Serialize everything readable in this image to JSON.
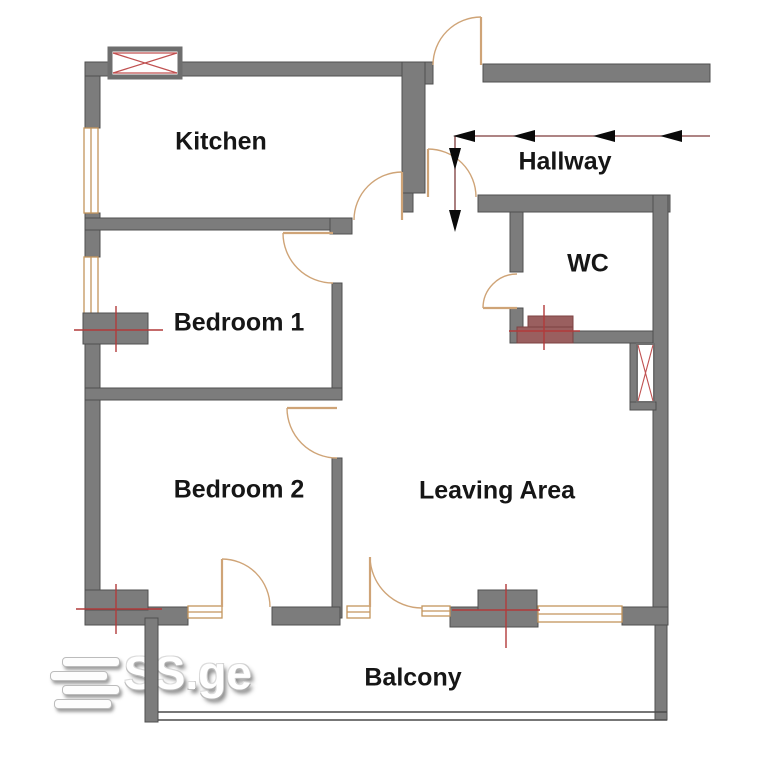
{
  "plan": {
    "rooms": [
      {
        "label": "Kitchen"
      },
      {
        "label": "Hallway"
      },
      {
        "label": "WC"
      },
      {
        "label": "Bedroom 1"
      },
      {
        "label": "Bedroom 2"
      },
      {
        "label": "Leaving Area"
      },
      {
        "label": "Balcony"
      }
    ],
    "colors": {
      "wall": "#7c7c7c",
      "wall_outline": "#4f4f4f",
      "door_arc": "#cfa477",
      "window_frame": "#c4955c",
      "fixture_red": "#b23a3a",
      "arrow_line": "#7d3b3b",
      "arrowhead": "#0a0a0a",
      "label_text": "#161616"
    },
    "symbols": [
      "vent-shaft",
      "duct-shaft",
      "radiator",
      "wc-fixture",
      "entry-direction-arrow"
    ]
  },
  "watermark": {
    "text": "SS.ge"
  }
}
